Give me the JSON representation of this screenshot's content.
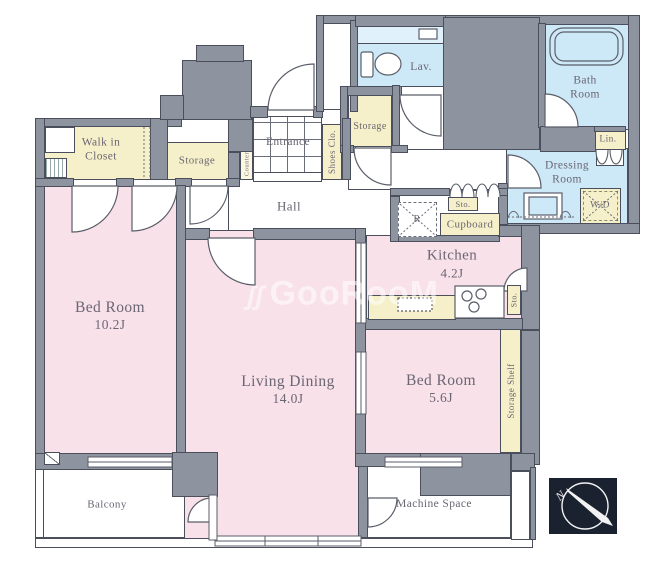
{
  "colors": {
    "wall": "#8e93a0",
    "wall-line": "#4b4f5b",
    "pink": "#f8e1e9",
    "yellow": "#f5f0c9",
    "blue": "#cde8f7",
    "blue2": "#e0f1fb",
    "floor": "#ffffff",
    "ink": "#6b6673",
    "compass-bg": "#1a2230"
  },
  "rooms": {
    "walk_in_closet": {
      "line1": "Walk in",
      "line2": "Closet"
    },
    "storage_left": {
      "label": "Storage"
    },
    "entrance": {
      "label": "Entrance"
    },
    "shoes_closet": {
      "label": "Shoes Clo."
    },
    "counter": {
      "label": "Counter"
    },
    "storage_hall": {
      "label": "Storage"
    },
    "hall": {
      "label": "Hall"
    },
    "lavatory": {
      "label": "Lav."
    },
    "bath": {
      "line1": "Bath",
      "line2": "Room"
    },
    "linen": {
      "label": "Lin."
    },
    "dressing": {
      "line1": "Dressing",
      "line2": "Room"
    },
    "washer_dryer": {
      "label": "W/D"
    },
    "storage_small_top": {
      "label": "Sto."
    },
    "cupboard": {
      "label": "Cupboard"
    },
    "refrigerator": {
      "label": "R"
    },
    "kitchen": {
      "name": "Kitchen",
      "size": "4.2J"
    },
    "storage_small_side": {
      "label": "Sto."
    },
    "bedroom_main": {
      "name": "Bed Room",
      "size": "10.2J"
    },
    "living_dining": {
      "name": "Living Dining",
      "size": "14.0J"
    },
    "bedroom_second": {
      "name": "Bed Room",
      "size": "5.6J"
    },
    "storage_shelf": {
      "label": "Storage Shelf"
    },
    "balcony": {
      "label": "Balcony"
    },
    "machine_space": {
      "label": "Machine Space"
    }
  },
  "compass": {
    "label": "N"
  },
  "watermark": {
    "icon": "ʃʃ",
    "text": "GooRooM"
  }
}
